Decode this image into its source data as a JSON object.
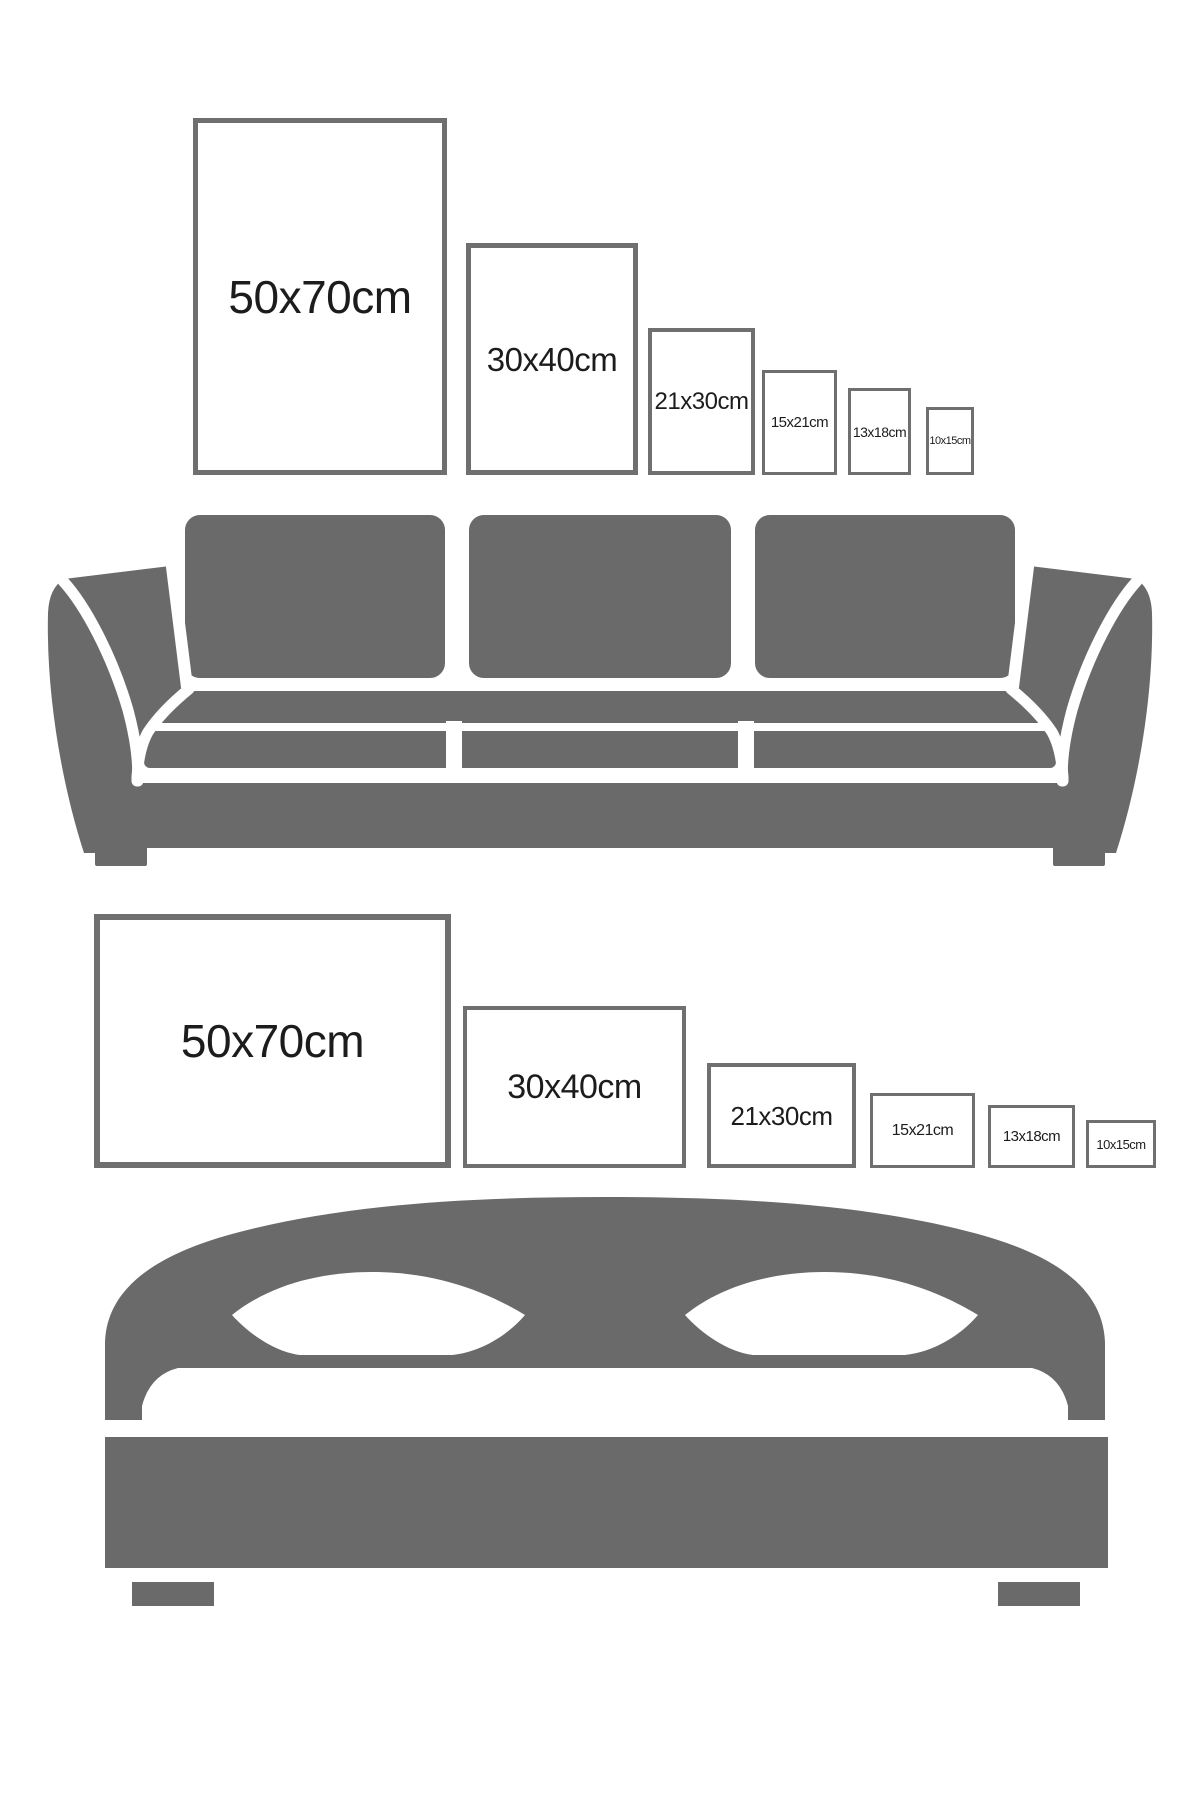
{
  "page": {
    "background": "#ffffff",
    "description": "Poster frame size comparison chart shown above a sofa (portrait frames) and above a double bed (landscape frames)"
  },
  "colors": {
    "furniture_silhouette": "#6a6a6a",
    "frame_border": "#6f6f6f",
    "frame_fill": "#ffffff",
    "label_text": "#1c1c1c"
  },
  "illustrations": {
    "sofa": "sofa-silhouette",
    "bed": "bed-silhouette"
  },
  "sections": [
    {
      "id": "sofa-comparison",
      "illustration": "sofa-silhouette",
      "frame_orientation": "portrait",
      "frames": [
        {
          "label": "50x70cm",
          "width_cm": 50,
          "height_cm": 70
        },
        {
          "label": "30x40cm",
          "width_cm": 30,
          "height_cm": 40
        },
        {
          "label": "21x30cm",
          "width_cm": 21,
          "height_cm": 30
        },
        {
          "label": "15x21cm",
          "width_cm": 15,
          "height_cm": 21
        },
        {
          "label": "13x18cm",
          "width_cm": 13,
          "height_cm": 18
        },
        {
          "label": "10x15cm",
          "width_cm": 10,
          "height_cm": 15
        }
      ]
    },
    {
      "id": "bed-comparison",
      "illustration": "bed-silhouette",
      "frame_orientation": "landscape",
      "frames": [
        {
          "label": "50x70cm",
          "width_cm": 70,
          "height_cm": 50
        },
        {
          "label": "30x40cm",
          "width_cm": 40,
          "height_cm": 30
        },
        {
          "label": "21x30cm",
          "width_cm": 30,
          "height_cm": 21
        },
        {
          "label": "15x21cm",
          "width_cm": 21,
          "height_cm": 15
        },
        {
          "label": "13x18cm",
          "width_cm": 18,
          "height_cm": 13
        },
        {
          "label": "10x15cm",
          "width_cm": 15,
          "height_cm": 10
        }
      ]
    }
  ]
}
